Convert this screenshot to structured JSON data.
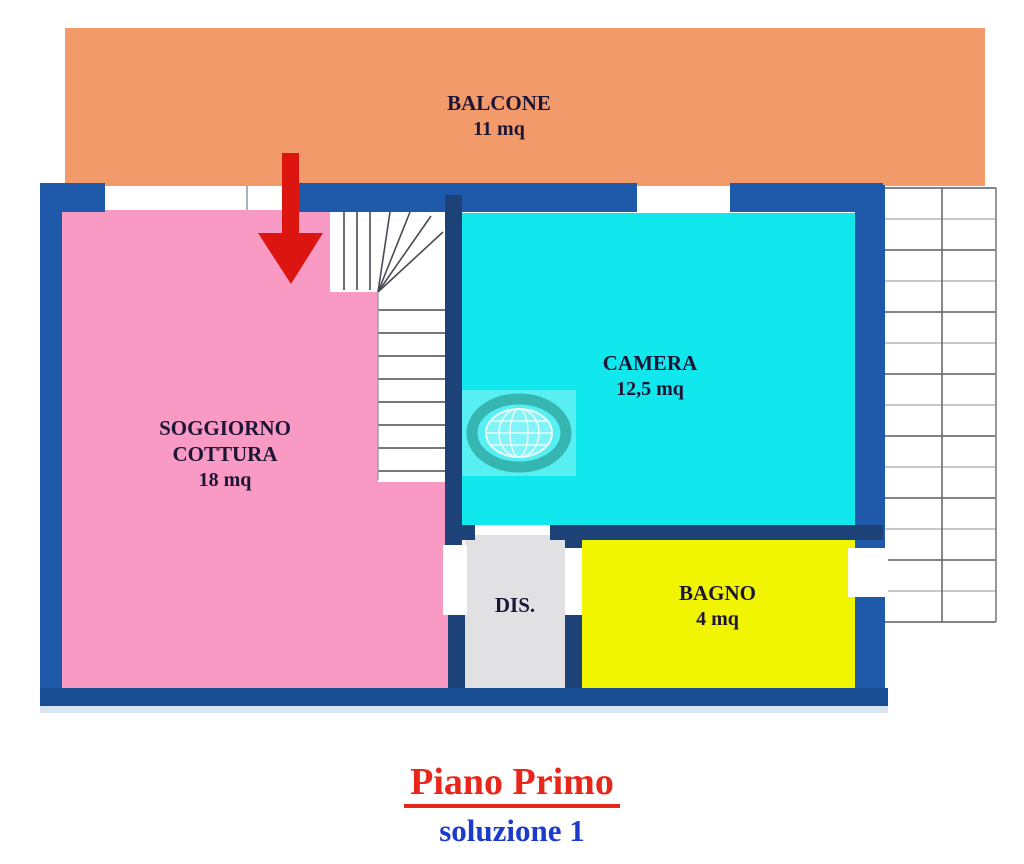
{
  "plan": {
    "rooms": {
      "balcone": {
        "name": "BALCONE",
        "area": "11 mq",
        "color": "#F29A69"
      },
      "soggiorno": {
        "name_line1": "SOGGIORNO",
        "name_line2": "COTTURA",
        "area": "18 mq",
        "color": "#F89AC4"
      },
      "camera": {
        "name": "CAMERA",
        "area": "12,5 mq",
        "color": "#10E8EE"
      },
      "dis": {
        "name": "DIS.",
        "color": "#E1E1E3"
      },
      "bagno": {
        "name": "BAGNO",
        "area": "4 mq",
        "color": "#F2F500"
      }
    },
    "walls": {
      "color": "#1E5AA9",
      "dark_color": "#1C4277"
    },
    "arrow": {
      "color": "#DD1510",
      "direction": "down"
    },
    "title": {
      "text": "Piano Primo",
      "color": "#E8271A"
    },
    "subtitle": {
      "text": "soluzione 1",
      "color": "#1B3BCC"
    },
    "icons": {
      "watermark": "globe-watermark-icon",
      "entrance": "down-arrow-icon"
    }
  }
}
